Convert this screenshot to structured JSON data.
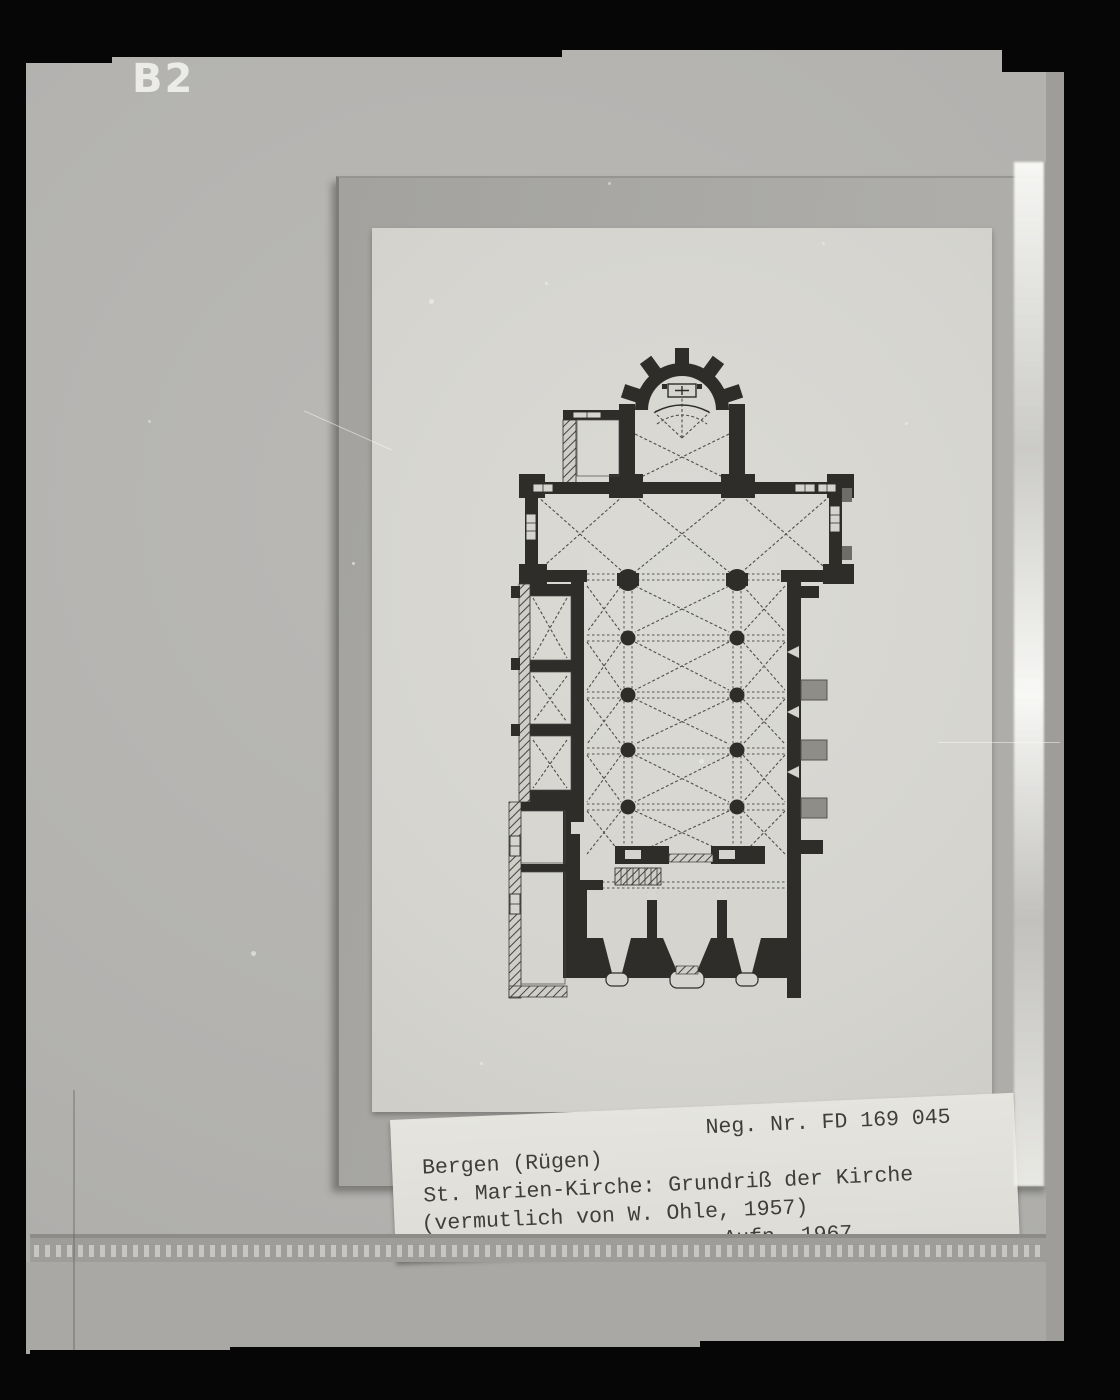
{
  "frame": {
    "corner_label": "B2"
  },
  "caption_label": {
    "neg_number": "Neg. Nr. FD 169 045",
    "location": "Bergen (Rügen)",
    "title": "St. Marien-Kirche: Grundriß der Kirche",
    "attribution": "(vermutlich von W. Ohle, 1957)",
    "photo_year": "Aufn. 1967"
  },
  "colors": {
    "frame_black": "#060606",
    "mount_gray": "#b3b2af",
    "mount_lower_gray": "#a9a8a4",
    "card_gray": "#a8a7a2",
    "sheet_white": "#d7d6d1",
    "label_white": "#e4e3de",
    "plan_ink": "#2e2d2a",
    "caption_text": "#3f3e39",
    "corner_label_white": "#ebebe8"
  }
}
